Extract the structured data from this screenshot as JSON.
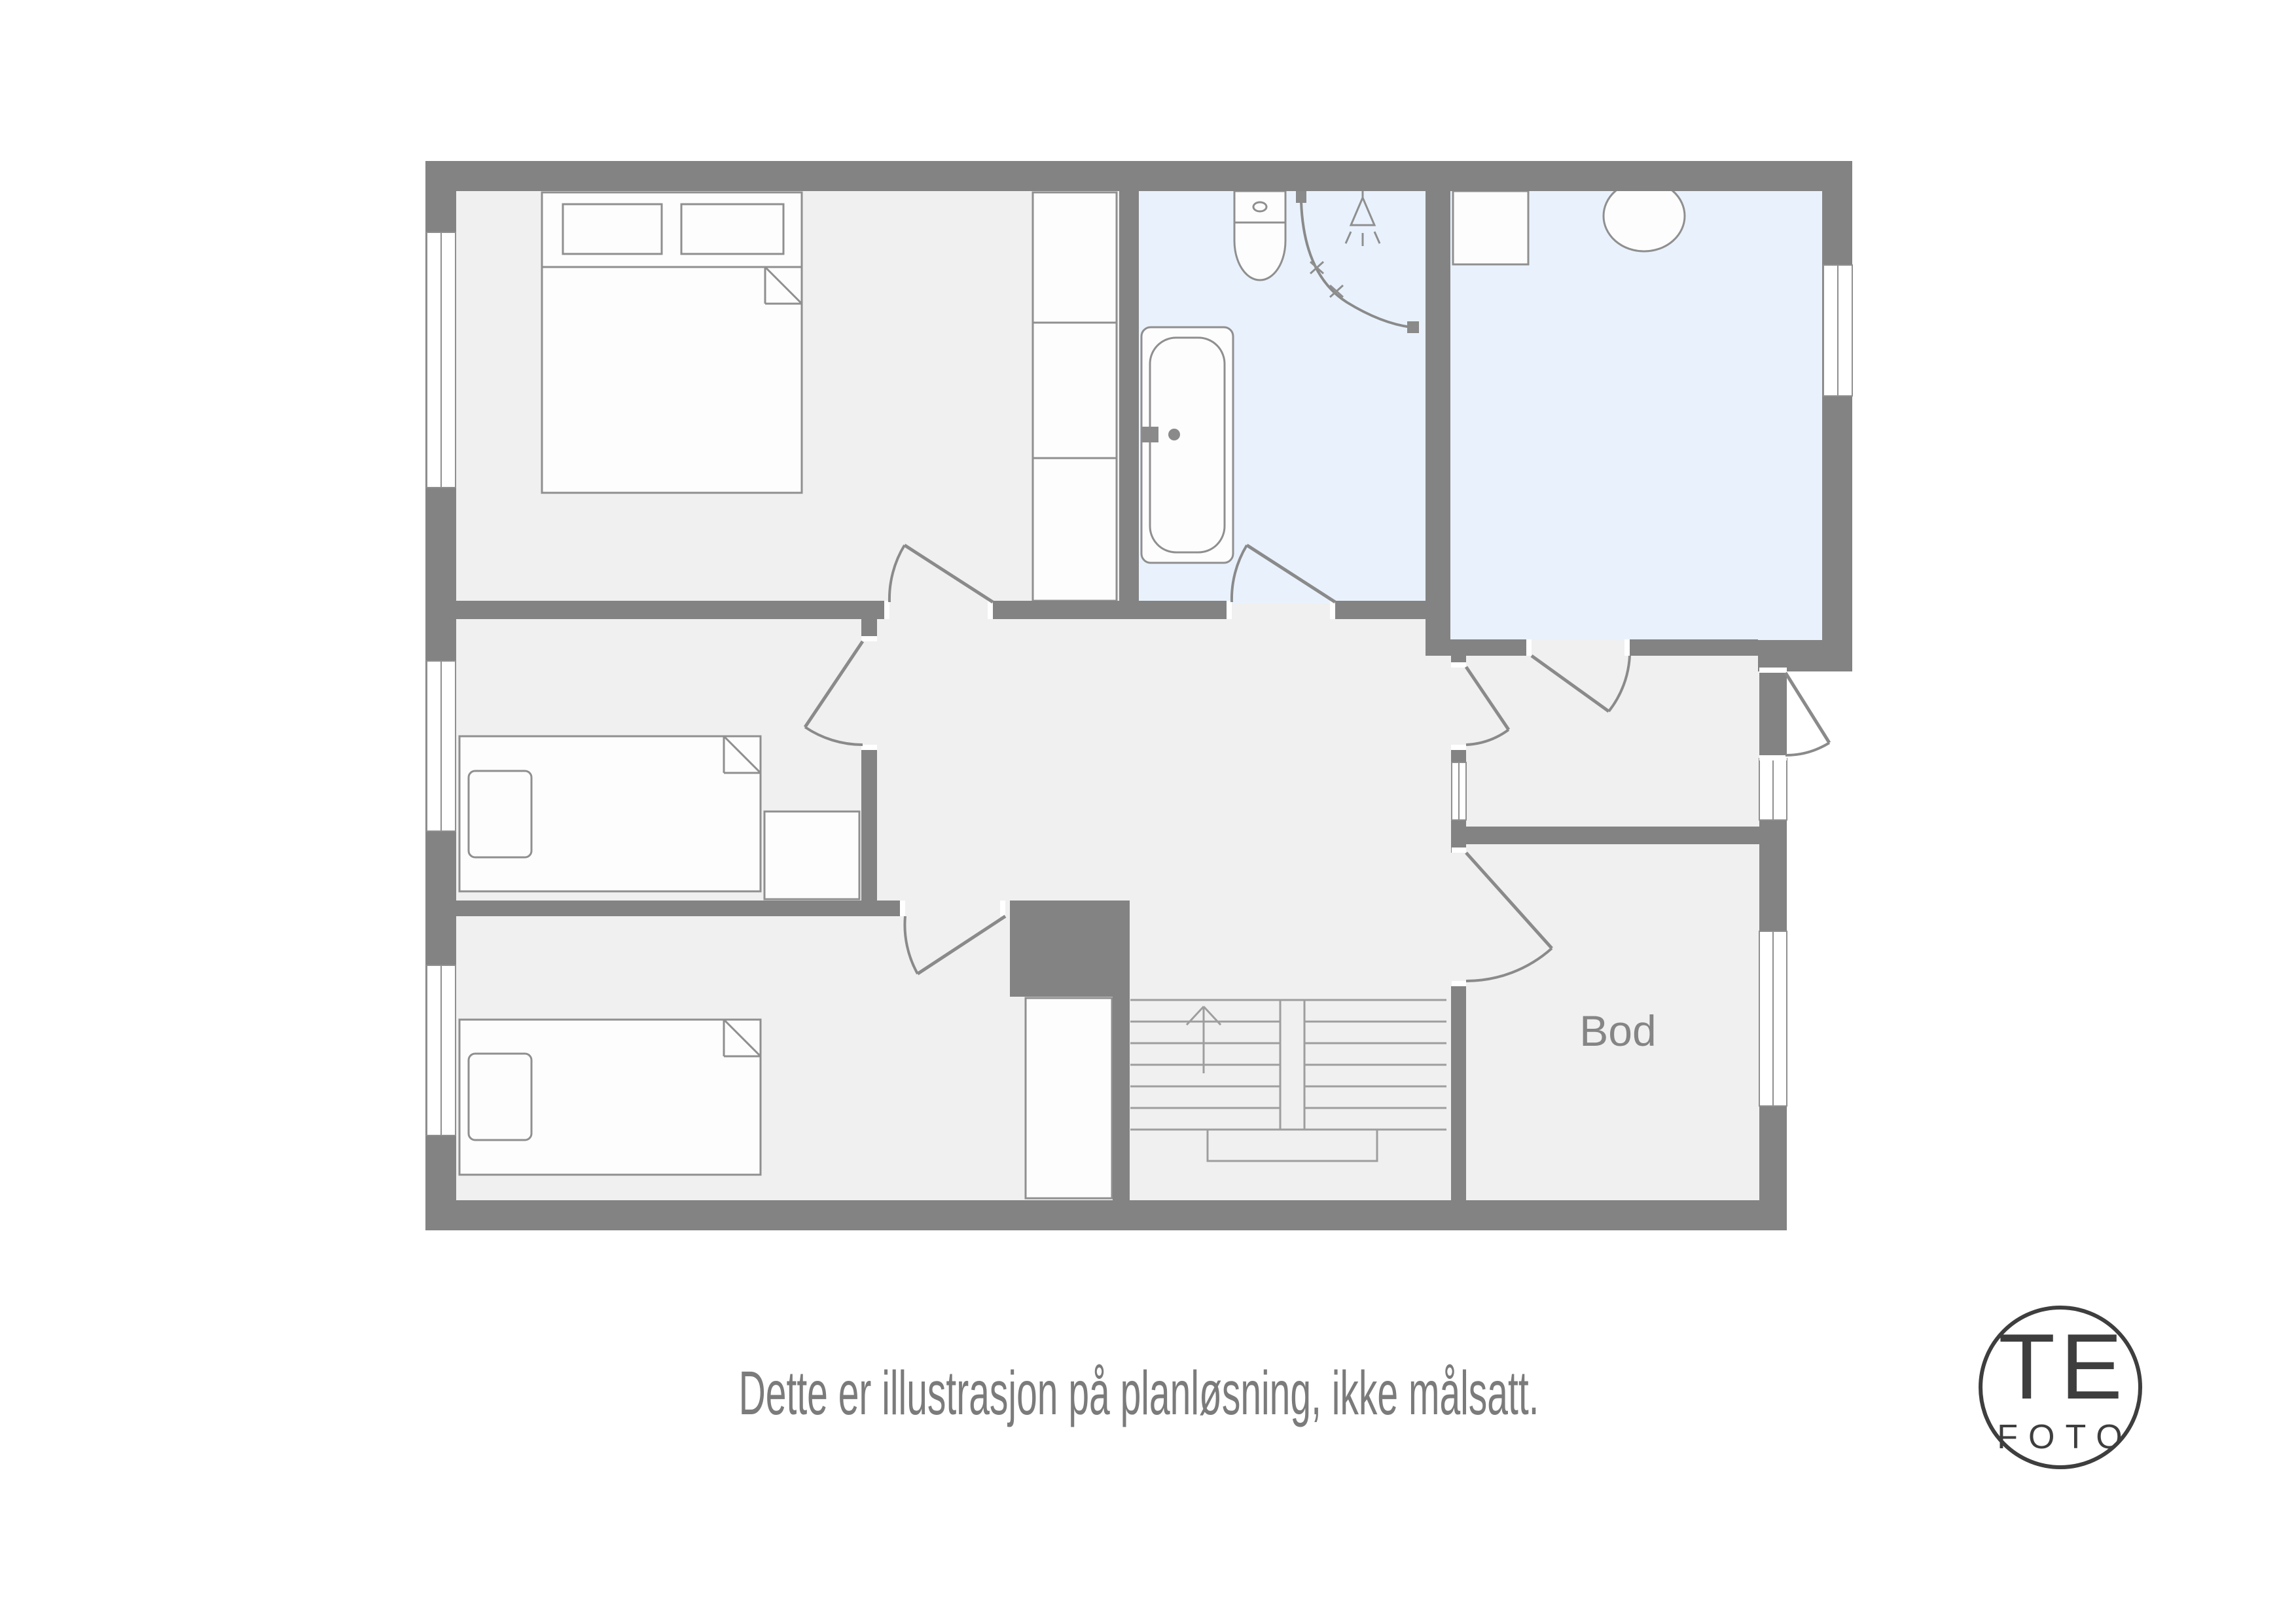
{
  "plan": {
    "caption": "Dette er illustrasjon på planløsning, ikke målsatt.",
    "room_labels": {
      "bod": "Bod"
    },
    "logo": {
      "top": "TE",
      "bottom": "FOTO"
    },
    "colors": {
      "wall": "#838383",
      "floor": "#f0f0f0",
      "wet": "#e9f2fc",
      "outline": "#8f8f8f",
      "door": "#8a8a8a",
      "furn": "#fdfdfd",
      "textgray": "#7b7b7b",
      "logo": "#3e3e3e"
    },
    "fixtures": [
      "double-bed",
      "wardrobe",
      "bathtub",
      "toilet",
      "shower",
      "washing-machine",
      "round-basin",
      "single-bed",
      "nightstand",
      "closet",
      "stairs",
      "entry-door"
    ]
  }
}
